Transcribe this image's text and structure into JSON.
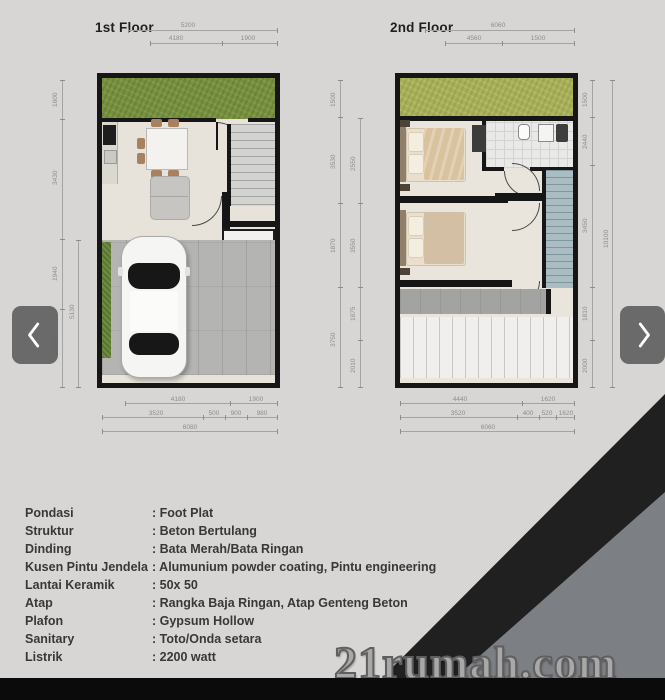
{
  "watermark": "21rumah.com",
  "colors": {
    "accent_green_floor1": "#77913d",
    "accent_green_floor2": "#a9b157",
    "wedge_dark": "#202020",
    "wedge_gray": "#7c7f83",
    "bottom_bar": "#0b0b0b"
  },
  "floor1": {
    "title": "1st Floor",
    "top_total": "5200",
    "top_seg1": "4180",
    "top_seg2": "1900",
    "left_segs": [
      "1600",
      "3430",
      "1940",
      "2530"
    ],
    "left_inner": "5130",
    "bottom_seg1": "4180",
    "bottom_seg2": "1900",
    "bottom_row2": [
      "3520",
      "500",
      "900",
      "980"
    ],
    "bottom_total": "6080"
  },
  "floor2": {
    "title": "2nd Floor",
    "top_total": "6060",
    "top_seg1": "4560",
    "top_seg2": "1500",
    "left_segs": [
      "1500",
      "3530",
      "1870",
      "3750"
    ],
    "left_inner": [
      "2550",
      "3550",
      "1875",
      "2010"
    ],
    "right_segs": [
      "1500",
      "2440",
      "3450",
      "1810",
      "2000"
    ],
    "right_total": "10100",
    "bottom_seg1": "4440",
    "bottom_seg2": "1620",
    "bottom_row2": [
      "3520",
      "400",
      "520",
      "1620"
    ],
    "bottom_total": "6060"
  },
  "specs": [
    {
      "label": "Pondasi",
      "value": ": Foot Plat"
    },
    {
      "label": "Struktur",
      "value": ": Beton Bertulang"
    },
    {
      "label": "Dinding",
      "value": ": Bata Merah/Bata Ringan"
    },
    {
      "label": "Kusen Pintu Jendela",
      "value": ": Alumunium powder coating, Pintu engineering"
    },
    {
      "label": "Lantai Keramik",
      "value": ": 50x 50"
    },
    {
      "label": "Atap",
      "value": ": Rangka Baja Ringan, Atap Genteng Beton"
    },
    {
      "label": "Plafon",
      "value": ": Gypsum Hollow"
    },
    {
      "label": "Sanitary",
      "value": ": Toto/Onda setara"
    },
    {
      "label": "Listrik",
      "value": ": 2200 watt"
    }
  ]
}
